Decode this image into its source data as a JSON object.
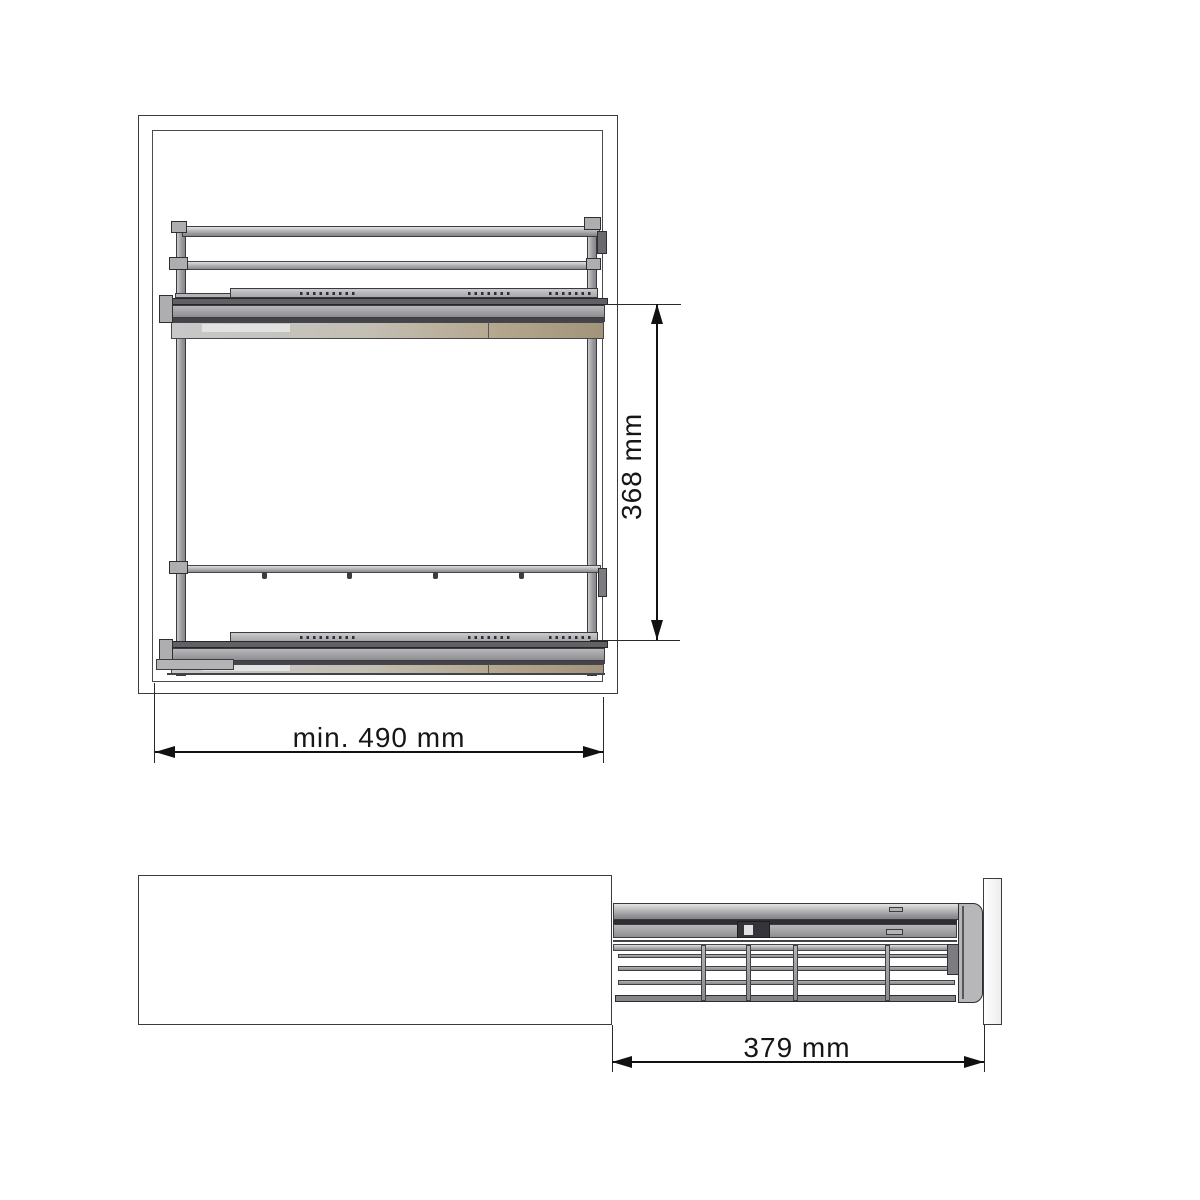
{
  "drawing": {
    "views": {
      "front": {
        "dimensions": {
          "inner_width": {
            "label": "min. 490 mm",
            "value": 490,
            "unit": "mm",
            "qualifier": "min."
          },
          "level_height": {
            "label": "368 mm",
            "value": 368,
            "unit": "mm"
          }
        }
      },
      "side": {
        "dimensions": {
          "extension": {
            "label": "379 mm",
            "value": 379,
            "unit": "mm"
          }
        }
      }
    },
    "colors": {
      "background": "#ffffff",
      "outline": "#3b3b3f",
      "dimension_line": "#111111",
      "metal_light": "#cacacc",
      "metal_mid": "#96969a",
      "metal_dark": "#606065",
      "bronze_tint": "#a99a7f"
    }
  }
}
